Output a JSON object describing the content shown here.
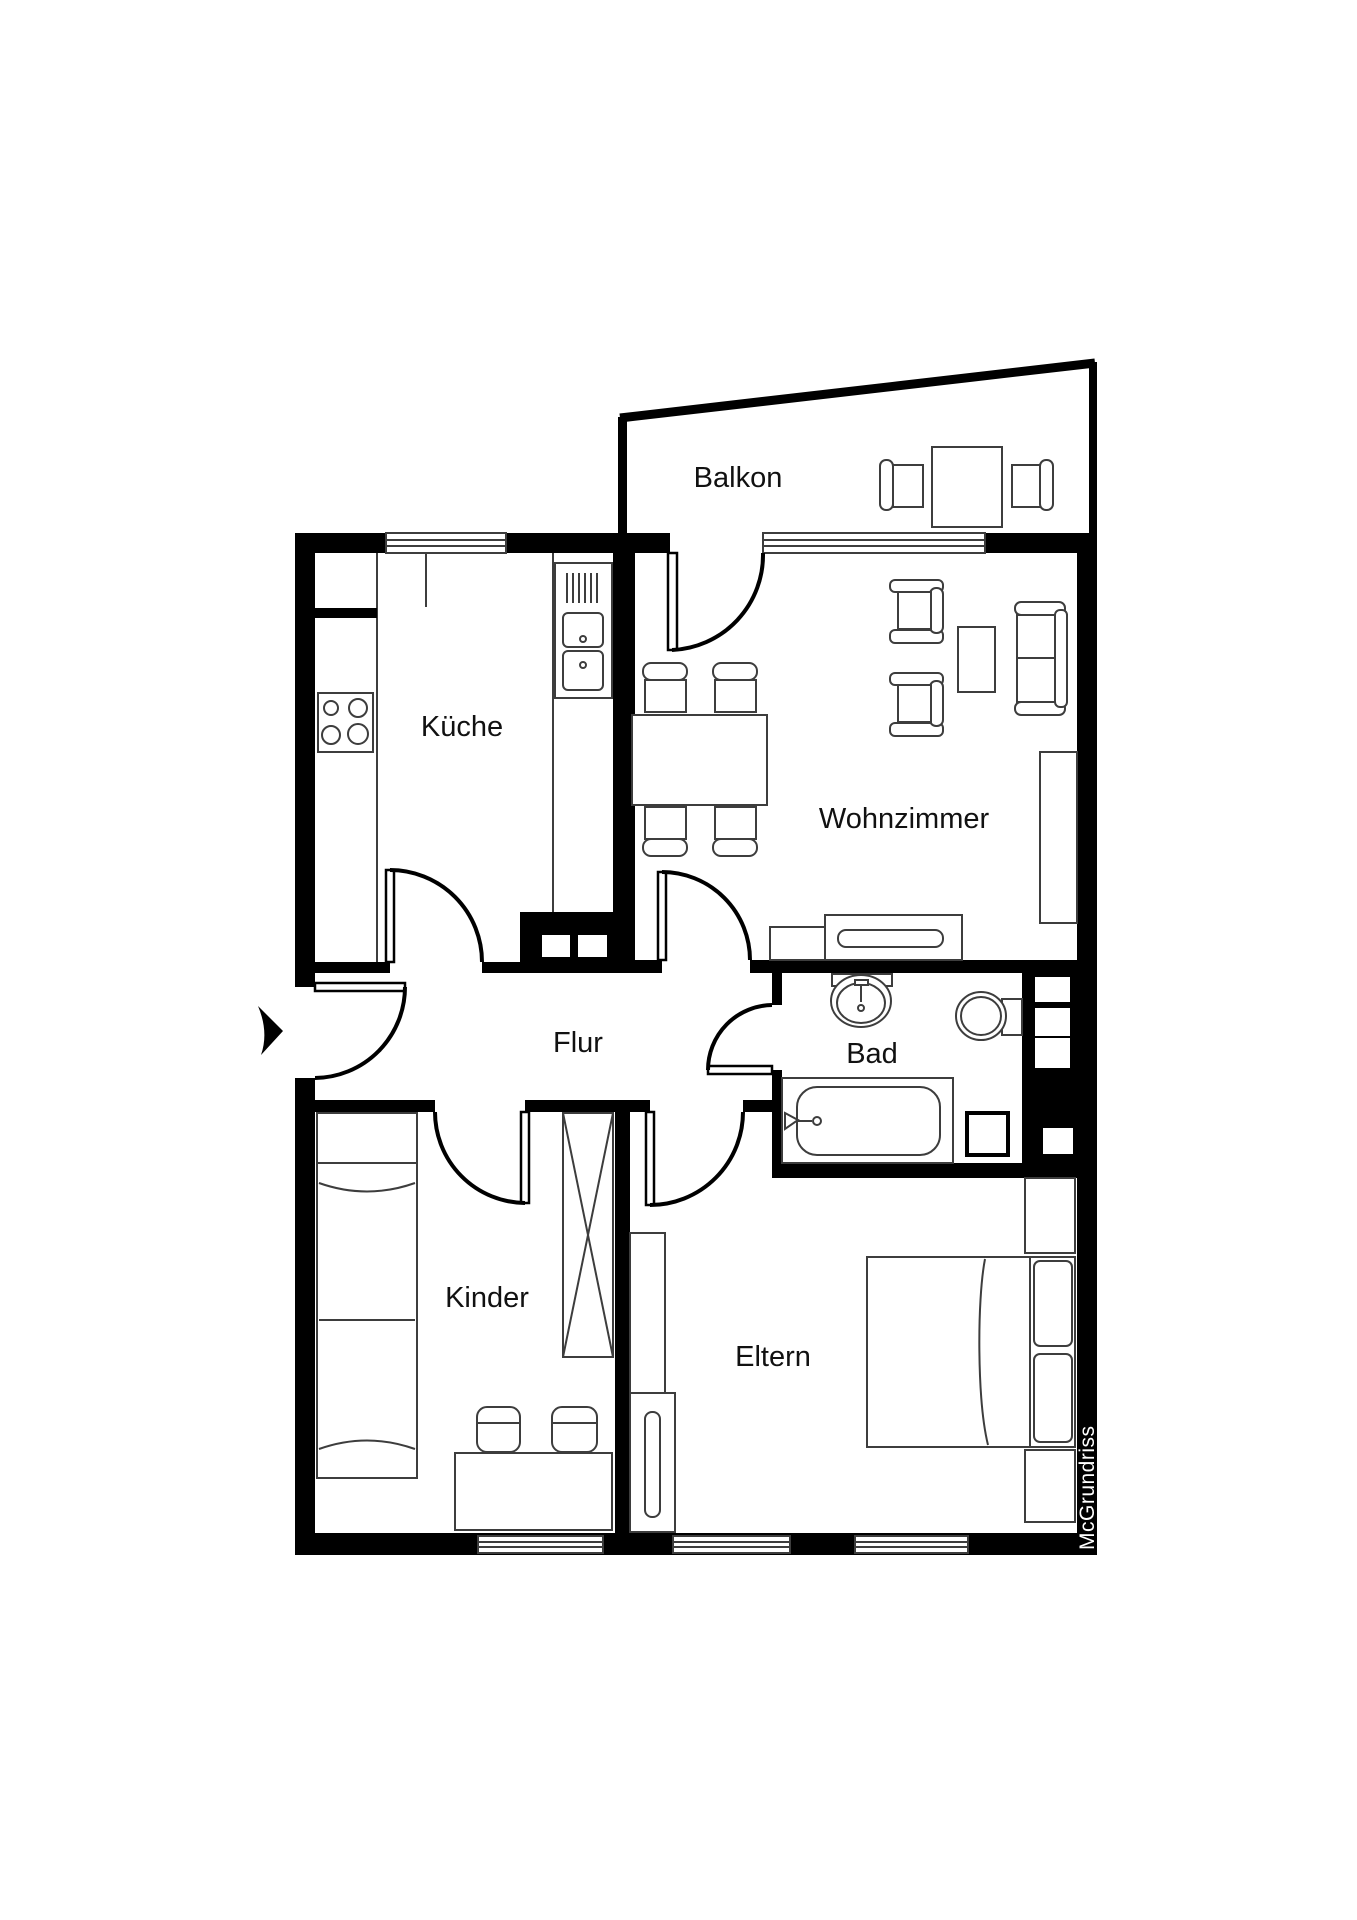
{
  "plan_title": "Apartment floor plan",
  "rooms": {
    "balkon": {
      "label": "Balkon"
    },
    "kueche": {
      "label": "Küche"
    },
    "wohnzimmer": {
      "label": "Wohnzimmer"
    },
    "flur": {
      "label": "Flur"
    },
    "bad": {
      "label": "Bad"
    },
    "kinder": {
      "label": "Kinder"
    },
    "eltern": {
      "label": "Eltern"
    }
  },
  "watermark": {
    "text": "McGrundriss"
  },
  "colors": {
    "wall": "#000000",
    "background": "#ffffff",
    "furniture_line": "#3d3d3d",
    "label_text": "#111111",
    "watermark_text": "#ffffff"
  }
}
